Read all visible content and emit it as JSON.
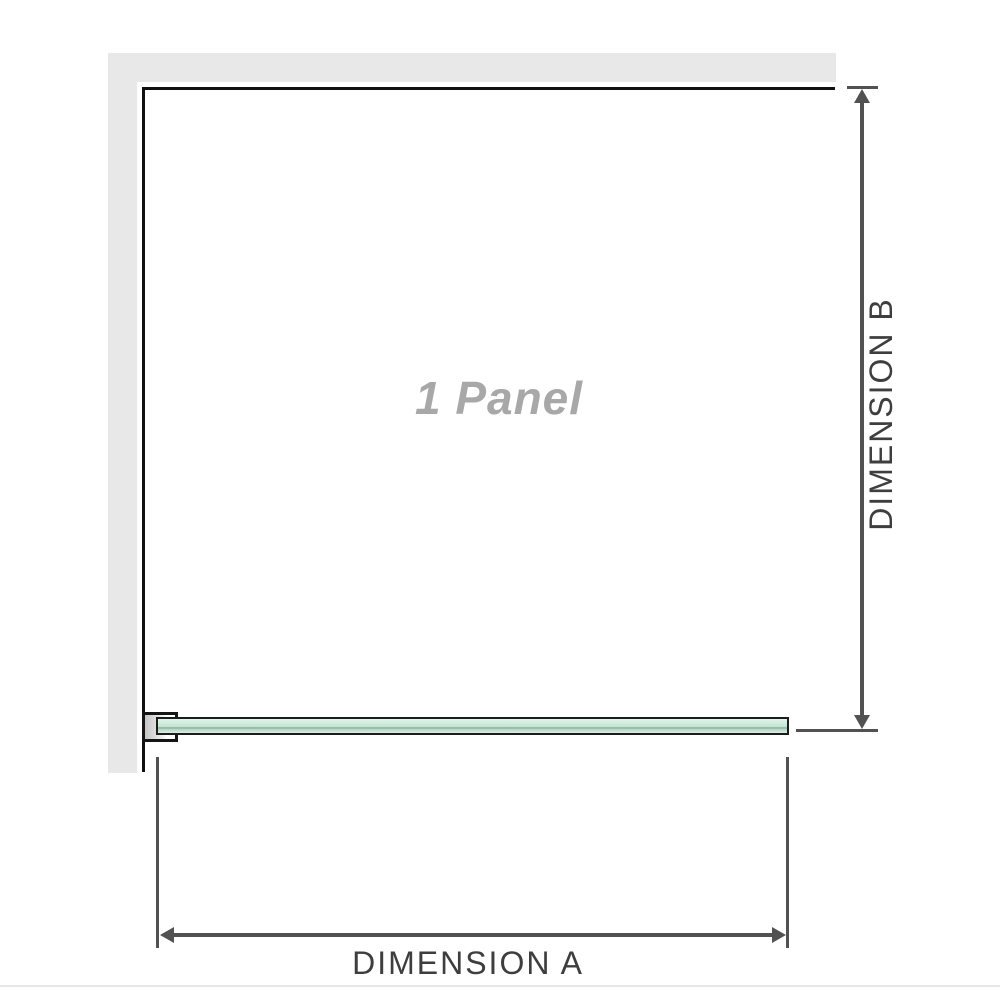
{
  "diagram": {
    "panel_label": "1 Panel",
    "dimension_a": {
      "label": "DIMENSION A"
    },
    "dimension_b": {
      "label": "DIMENSION B"
    }
  },
  "icons": {
    "dimension_b_arrow": "vertical-double-arrow",
    "dimension_a_arrow": "horizontal-double-arrow"
  },
  "colors": {
    "wall_gray": "#e8e8e8",
    "panel_border": "#101010",
    "glass_green_fill": "#c0e6d0",
    "glass_green_highlight": "#e3f4ea",
    "glass_green_shadow": "#8fa79a",
    "glass_border": "#1c1c1c",
    "clamp_metal": "#c6c6c6",
    "dimension_line": "#525252",
    "dimension_text": "#3e3e3e",
    "watermark_text": "#a8a8a8",
    "separator": "#e7e7e7",
    "background": "#ffffff"
  }
}
